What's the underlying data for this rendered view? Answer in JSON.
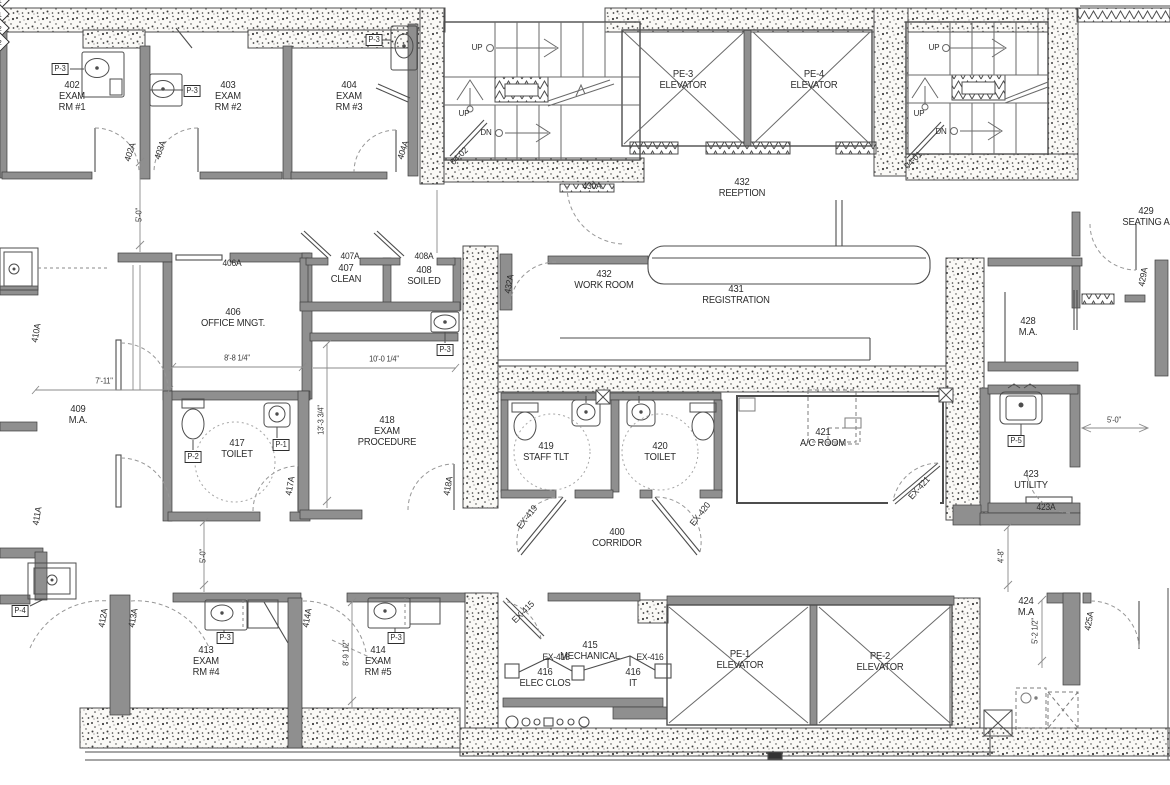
{
  "drawing": {
    "kind": "architectural floor plan",
    "colors": {
      "background": "#ffffff",
      "line": "#4d4d4d",
      "wall_fill": "#8f8f8f",
      "stipple_dot": "#3f3f3f",
      "dashed": "#999999",
      "text": "#2d2d2d"
    }
  },
  "rooms": [
    {
      "label": "402\nEXAM\nRM #1",
      "x": 72,
      "y": 97
    },
    {
      "label": "403\nEXAM\nRM #2",
      "x": 228,
      "y": 97
    },
    {
      "label": "404\nEXAM\nRM #3",
      "x": 349,
      "y": 97
    },
    {
      "label": "PE-3\nELEVATOR",
      "x": 683,
      "y": 80
    },
    {
      "label": "PE-4\nELEVATOR",
      "x": 814,
      "y": 80
    },
    {
      "label": "432\nREEPTION",
      "x": 742,
      "y": 188
    },
    {
      "label": "429\nSEATING A",
      "x": 1146,
      "y": 217
    },
    {
      "label": "407\nCLEAN",
      "x": 346,
      "y": 274
    },
    {
      "label": "408\nSOILED",
      "x": 424,
      "y": 276
    },
    {
      "label": "432\nWORK ROOM",
      "x": 604,
      "y": 280
    },
    {
      "label": "431\nREGISTRATION",
      "x": 736,
      "y": 295
    },
    {
      "label": "406\nOFFICE MNGT.",
      "x": 233,
      "y": 318
    },
    {
      "label": "428\nM.A.",
      "x": 1028,
      "y": 327
    },
    {
      "label": "409\nM.A.",
      "x": 78,
      "y": 415
    },
    {
      "label": "417\nTOILET",
      "x": 237,
      "y": 449
    },
    {
      "label": "418\nEXAM\nPROCEDURE",
      "x": 387,
      "y": 432
    },
    {
      "label": "419\nSTAFF TLT",
      "x": 546,
      "y": 452
    },
    {
      "label": "420\nTOILET",
      "x": 660,
      "y": 452
    },
    {
      "label": "421\nA/C ROOM",
      "x": 823,
      "y": 438
    },
    {
      "label": "423\nUTILITY",
      "x": 1031,
      "y": 480
    },
    {
      "label": "400\nCORRIDOR",
      "x": 617,
      "y": 538
    },
    {
      "label": "424\nM.A",
      "x": 1026,
      "y": 607
    },
    {
      "label": "413\nEXAM\nRM #4",
      "x": 206,
      "y": 662
    },
    {
      "label": "414\nEXAM\nRM #5",
      "x": 378,
      "y": 662
    },
    {
      "label": "415\nMECHANICAL",
      "x": 590,
      "y": 651
    },
    {
      "label": "416\nELEC CLOS",
      "x": 545,
      "y": 678
    },
    {
      "label": "416\nIT",
      "x": 633,
      "y": 678
    },
    {
      "label": "PE-1\nELEVATOR",
      "x": 740,
      "y": 660
    },
    {
      "label": "PE-2\nELEVATOR",
      "x": 880,
      "y": 662
    }
  ],
  "door_tags": [
    {
      "text": "402A",
      "x": 130,
      "y": 152,
      "rot": -72
    },
    {
      "text": "403A",
      "x": 160,
      "y": 150,
      "rot": -72
    },
    {
      "text": "404A",
      "x": 403,
      "y": 150,
      "rot": -72
    },
    {
      "text": "04-02",
      "x": 459,
      "y": 156,
      "rot": -45
    },
    {
      "text": "430A",
      "x": 592,
      "y": 186,
      "rot": 0
    },
    {
      "text": "04-01",
      "x": 913,
      "y": 160,
      "rot": -45
    },
    {
      "text": "406A",
      "x": 232,
      "y": 263,
      "rot": 0
    },
    {
      "text": "407A",
      "x": 350,
      "y": 256,
      "rot": 0
    },
    {
      "text": "408A",
      "x": 424,
      "y": 256,
      "rot": 0
    },
    {
      "text": "432A",
      "x": 509,
      "y": 284,
      "rot": -80
    },
    {
      "text": "429A",
      "x": 1143,
      "y": 277,
      "rot": -80
    },
    {
      "text": "410A",
      "x": 36,
      "y": 333,
      "rot": -80
    },
    {
      "text": "411A",
      "x": 37,
      "y": 516,
      "rot": -80
    },
    {
      "text": "417A",
      "x": 290,
      "y": 486,
      "rot": -80
    },
    {
      "text": "418A",
      "x": 448,
      "y": 486,
      "rot": -80
    },
    {
      "text": "EX-419",
      "x": 527,
      "y": 517,
      "rot": -52
    },
    {
      "text": "EX-420",
      "x": 700,
      "y": 514,
      "rot": -52
    },
    {
      "text": "EX-421",
      "x": 919,
      "y": 488,
      "rot": -48
    },
    {
      "text": "EX-415",
      "x": 523,
      "y": 612,
      "rot": -45
    },
    {
      "text": "EX-416",
      "x": 556,
      "y": 657,
      "rot": 0
    },
    {
      "text": "EX-416",
      "x": 650,
      "y": 657,
      "rot": 0
    },
    {
      "text": "423A",
      "x": 1046,
      "y": 507,
      "rot": 0
    },
    {
      "text": "412A",
      "x": 103,
      "y": 618,
      "rot": -80
    },
    {
      "text": "413A",
      "x": 133,
      "y": 618,
      "rot": -80
    },
    {
      "text": "414A",
      "x": 307,
      "y": 618,
      "rot": -80
    },
    {
      "text": "425A",
      "x": 1089,
      "y": 621,
      "rot": -80
    }
  ],
  "fixture_tags": [
    {
      "text": "P-3",
      "x": 60,
      "y": 69
    },
    {
      "text": "P-3",
      "x": 192,
      "y": 91
    },
    {
      "text": "P-3",
      "x": 374,
      "y": 40
    },
    {
      "text": "P-3",
      "x": 445,
      "y": 350
    },
    {
      "text": "P-2",
      "x": 193,
      "y": 457
    },
    {
      "text": "P-1",
      "x": 281,
      "y": 445
    },
    {
      "text": "P-5",
      "x": 1016,
      "y": 441
    },
    {
      "text": "P-4",
      "x": 20,
      "y": 611
    },
    {
      "text": "P-3",
      "x": 225,
      "y": 638
    },
    {
      "text": "P-3",
      "x": 396,
      "y": 638
    }
  ],
  "dimensions": [
    {
      "text": "5'-0\"",
      "x": 140,
      "y": 215,
      "rot": -90
    },
    {
      "text": "8'-8 1/4\"",
      "x": 237,
      "y": 359,
      "rot": 0
    },
    {
      "text": "10'-0 1/4\"",
      "x": 384,
      "y": 360,
      "rot": 0
    },
    {
      "text": "7'-11\"",
      "x": 104,
      "y": 382,
      "rot": 0
    },
    {
      "text": "13'-3 3/4\"",
      "x": 322,
      "y": 420,
      "rot": -90
    },
    {
      "text": "5'-0\"",
      "x": 204,
      "y": 556,
      "rot": -90
    },
    {
      "text": "8'-9 1/2\"",
      "x": 347,
      "y": 653,
      "rot": -90
    },
    {
      "text": "5'-0\"",
      "x": 1114,
      "y": 421,
      "rot": 0
    },
    {
      "text": "4'-8\"",
      "x": 1002,
      "y": 556,
      "rot": -90
    },
    {
      "text": "5'-2 1/2\"",
      "x": 1036,
      "y": 631,
      "rot": -90
    }
  ],
  "stair_labels": [
    {
      "text": "UP",
      "x": 477,
      "y": 48,
      "rot": 0
    },
    {
      "text": "UP",
      "x": 464,
      "y": 114,
      "rot": 0
    },
    {
      "text": "DN",
      "x": 486,
      "y": 133,
      "rot": 0
    },
    {
      "text": "UP",
      "x": 934,
      "y": 48,
      "rot": 0
    },
    {
      "text": "UP",
      "x": 919,
      "y": 114,
      "rot": 0
    },
    {
      "text": "DN",
      "x": 941,
      "y": 132,
      "rot": 0
    }
  ],
  "keyed_notes": [
    {
      "text": "1",
      "x": 586,
      "y": 388
    },
    {
      "text": "1",
      "x": 639,
      "y": 387
    },
    {
      "text": "2",
      "x": 556,
      "y": 475
    },
    {
      "text": "2",
      "x": 673,
      "y": 471
    }
  ]
}
